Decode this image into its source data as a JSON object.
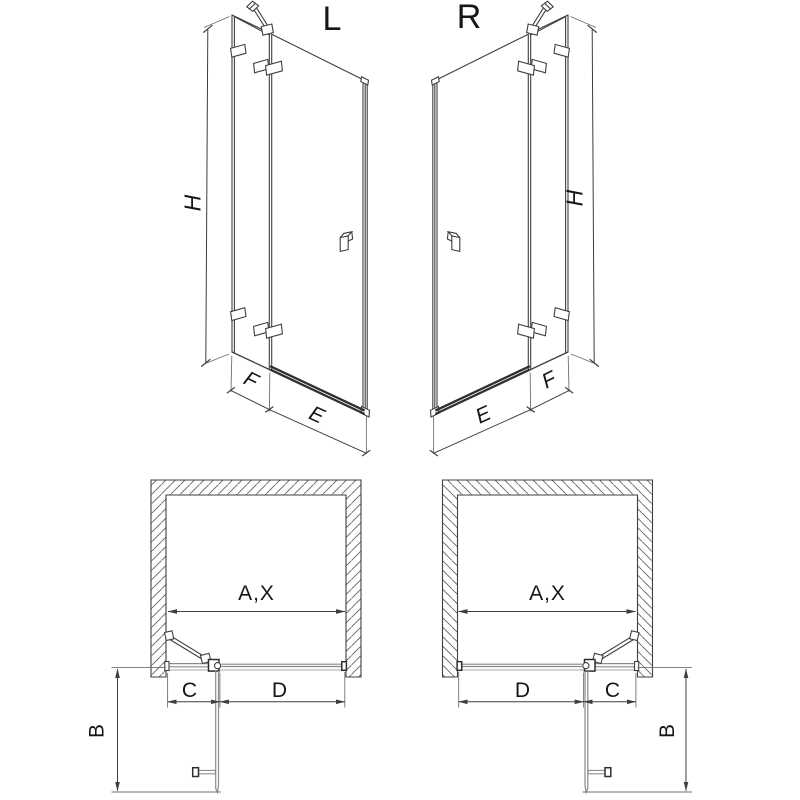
{
  "diagram": {
    "type": "technical-drawing",
    "subject": "Hinged shower door with fixed panel, left and right variants: front 3D views and plan views with dimension letters",
    "variants": {
      "left": {
        "label": "L"
      },
      "right": {
        "label": "R"
      }
    },
    "dimensions": {
      "height": "H",
      "fixed_panel_width": "F",
      "door_width": "E",
      "opening_width": "A,X",
      "fixed_segment": "C",
      "door_segment": "D",
      "door_swing_depth": "B"
    },
    "colors": {
      "background": "#ffffff",
      "line": "#3f3f3f",
      "glass_line": "#8a8a8a",
      "hatch": "#5f5f5f",
      "text": "#161616"
    }
  }
}
